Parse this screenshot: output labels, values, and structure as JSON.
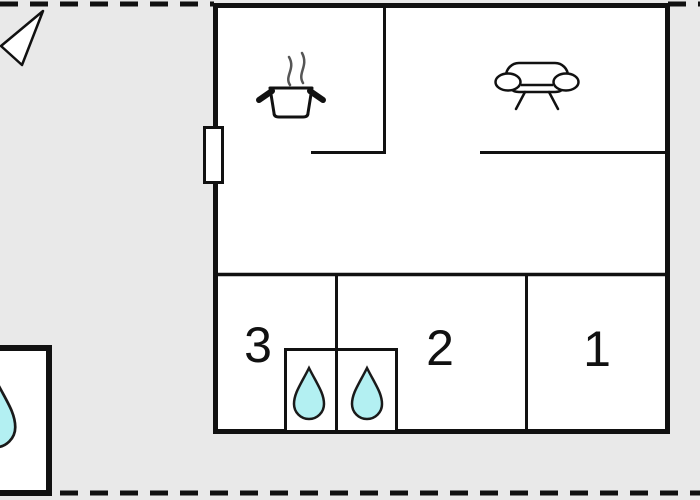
{
  "floor_plan": {
    "rooms": [
      {
        "label": "3"
      },
      {
        "label": "2"
      },
      {
        "label": "1"
      }
    ],
    "bathroom": {
      "drop_count": 2
    },
    "annex": {
      "drop_count": 1
    },
    "icons": [
      {
        "name": "north-arrow-icon",
        "glyph": "outlined-triangle-pointing-left"
      },
      {
        "name": "cooking-pot-icon",
        "glyph": "pot-with-steam"
      },
      {
        "name": "sofa-icon",
        "glyph": "couch-outline"
      },
      {
        "name": "water-drop-icon",
        "glyph": "teardrop"
      },
      {
        "name": "window-icon",
        "glyph": "white-rect-on-wall"
      }
    ],
    "colors": {
      "background": "#e9e9e9",
      "plan_fill": "#ffffff",
      "wall": "#111111",
      "drop_fill": "#b3f0f2",
      "drop_stroke": "#1a1a1a",
      "steam": "#555555"
    }
  }
}
